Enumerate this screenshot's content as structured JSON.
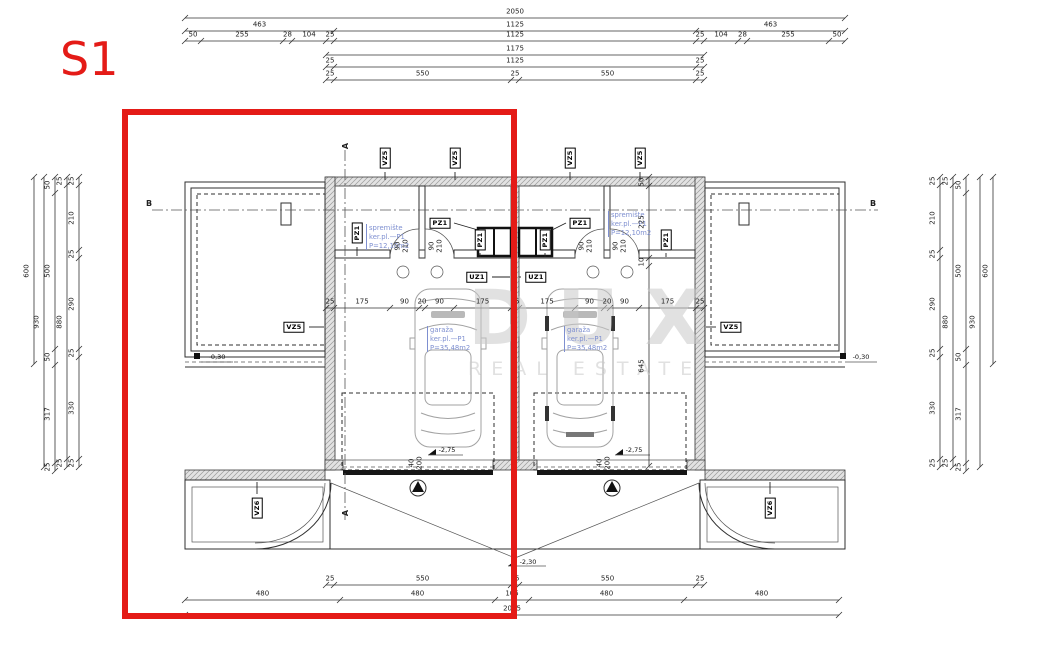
{
  "meta": {
    "title": "S1"
  },
  "watermark": {
    "line1": "DUX",
    "line2": "REAL ESTATE"
  },
  "colors": {
    "accent": "#e41b17",
    "blueprint_text": "#7e8fd0",
    "watermark": "#c9c9c9"
  },
  "rooms": [
    {
      "name": "spremište",
      "finish": "ker.pl.—P1",
      "area": "P=12,10m2"
    },
    {
      "name": "spremište",
      "finish": "ker.pl.—P1",
      "area": "P=12,10m2"
    },
    {
      "name": "garaža",
      "finish": "ker.pl.—P1",
      "area": "P=35,48m2"
    },
    {
      "name": "garaža",
      "finish": "ker.pl.—P1",
      "area": "P=35,48m2"
    }
  ],
  "dims": [
    {
      "o": "h",
      "y": 18,
      "t": [
        185,
        845
      ],
      "v": [
        "2050"
      ]
    },
    {
      "o": "h",
      "y": 31,
      "t": [
        185,
        334,
        696,
        845
      ],
      "v": [
        "463",
        "1125",
        "463"
      ]
    },
    {
      "o": "h",
      "y": 41,
      "t": [
        185,
        201,
        283,
        292,
        326,
        334,
        696,
        704,
        738,
        747,
        829,
        845
      ],
      "v": [
        "50",
        "255",
        "28",
        "104",
        "25",
        "1125",
        "25",
        "104",
        "28",
        "255",
        "50"
      ]
    },
    {
      "o": "h",
      "y": 55,
      "t": [
        326,
        704
      ],
      "v": [
        "1175"
      ]
    },
    {
      "o": "h",
      "y": 67,
      "t": [
        326,
        334,
        696,
        704
      ],
      "v": [
        "25",
        "1125",
        "25"
      ]
    },
    {
      "o": "h",
      "y": 80,
      "t": [
        326,
        334,
        511,
        519,
        696,
        704
      ],
      "v": [
        "25",
        "550",
        "25",
        "550",
        "25"
      ]
    },
    {
      "o": "h",
      "y": 308,
      "t": [
        326,
        334,
        390,
        419,
        425,
        454,
        511,
        519,
        575,
        604,
        610,
        639,
        696,
        704
      ],
      "v": [
        "25",
        "175",
        "90",
        "20",
        "90",
        "175",
        "25",
        "175",
        "90",
        "20",
        "90",
        "175",
        "25"
      ]
    },
    {
      "o": "h",
      "y": 585,
      "t": [
        326,
        334,
        511,
        519,
        696,
        704
      ],
      "v": [
        "25",
        "550",
        "25",
        "550",
        "25"
      ]
    },
    {
      "o": "h",
      "y": 600,
      "t": [
        185,
        340,
        495,
        529,
        684,
        839
      ],
      "v": [
        "480",
        "480",
        "105",
        "480",
        "480"
      ]
    },
    {
      "o": "h",
      "y": 615,
      "t": [
        185,
        839
      ],
      "v": [
        "2025"
      ]
    },
    {
      "o": "v",
      "x": 34,
      "t": [
        177,
        364
      ],
      "v": [
        "600"
      ]
    },
    {
      "o": "v",
      "x": 44,
      "t": [
        177,
        467
      ],
      "v": [
        "930"
      ]
    },
    {
      "o": "v",
      "x": 55,
      "t": [
        177,
        193,
        349,
        365,
        463,
        471
      ],
      "v": [
        "50",
        "500",
        "50",
        "317",
        "25"
      ]
    },
    {
      "o": "v",
      "x": 67,
      "t": [
        177,
        185,
        459,
        467
      ],
      "v": [
        "25",
        "880",
        "25"
      ]
    },
    {
      "o": "v",
      "x": 79,
      "t": [
        177,
        185,
        250,
        258,
        349,
        357,
        459,
        467
      ],
      "v": [
        "25",
        "210",
        "25",
        "290",
        "25",
        "330",
        "25"
      ]
    },
    {
      "o": "v",
      "x": 993,
      "t": [
        177,
        364
      ],
      "v": [
        "600"
      ]
    },
    {
      "o": "v",
      "x": 980,
      "t": [
        177,
        467
      ],
      "v": [
        "930"
      ]
    },
    {
      "o": "v",
      "x": 966,
      "t": [
        177,
        193,
        349,
        365,
        463,
        471
      ],
      "v": [
        "50",
        "500",
        "50",
        "317",
        "25"
      ]
    },
    {
      "o": "v",
      "x": 953,
      "t": [
        177,
        185,
        459,
        467
      ],
      "v": [
        "25",
        "880",
        "25"
      ]
    },
    {
      "o": "v",
      "x": 940,
      "t": [
        177,
        185,
        250,
        258,
        349,
        357,
        459,
        467
      ],
      "v": [
        "25",
        "210",
        "25",
        "290",
        "25",
        "330",
        "25"
      ]
    },
    {
      "o": "v",
      "x": 649,
      "t": [
        177,
        186,
        258,
        266,
        466
      ],
      "v": [
        "50",
        "225",
        "10",
        "645"
      ]
    }
  ],
  "labels": [
    {
      "t": "A",
      "x": 346,
      "y": 146,
      "r": 1,
      "c": "sec"
    },
    {
      "t": "A",
      "x": 346,
      "y": 513,
      "r": 1,
      "c": "sec"
    },
    {
      "t": "B",
      "x": 149,
      "y": 204,
      "c": "sec"
    },
    {
      "t": "B",
      "x": 873,
      "y": 204,
      "c": "sec"
    },
    {
      "t": "90",
      "x": 398,
      "y": 246,
      "r": 1
    },
    {
      "t": "210",
      "x": 406,
      "y": 246,
      "r": 1
    },
    {
      "t": "90",
      "x": 432,
      "y": 246,
      "r": 1
    },
    {
      "t": "210",
      "x": 440,
      "y": 246,
      "r": 1
    },
    {
      "t": "90",
      "x": 582,
      "y": 246,
      "r": 1
    },
    {
      "t": "210",
      "x": 590,
      "y": 246,
      "r": 1
    },
    {
      "t": "90",
      "x": 616,
      "y": 246,
      "r": 1
    },
    {
      "t": "210",
      "x": 624,
      "y": 246,
      "r": 1
    },
    {
      "t": "40",
      "x": 412,
      "y": 463,
      "r": 1
    },
    {
      "t": "200",
      "x": 420,
      "y": 463,
      "r": 1
    },
    {
      "t": "40",
      "x": 600,
      "y": 463,
      "r": 1
    },
    {
      "t": "200",
      "x": 608,
      "y": 463,
      "r": 1
    },
    {
      "t": "-2,75",
      "x": 447,
      "y": 450,
      "c": "lvl"
    },
    {
      "t": "-2,75",
      "x": 634,
      "y": 450,
      "c": "lvl"
    },
    {
      "t": "-2,30",
      "x": 528,
      "y": 562,
      "c": "lvl"
    },
    {
      "t": "-0,30",
      "x": 217,
      "y": 357,
      "c": "lvl"
    },
    {
      "t": "-0,30",
      "x": 861,
      "y": 357,
      "c": "lvl"
    }
  ],
  "tags": [
    {
      "t": "VZ5",
      "x": 385,
      "y": 158,
      "r": 1,
      "l": [
        385,
        172,
        385,
        180
      ]
    },
    {
      "t": "VZ5",
      "x": 455,
      "y": 158,
      "r": 1,
      "l": [
        455,
        172,
        455,
        180
      ]
    },
    {
      "t": "VZ5",
      "x": 570,
      "y": 158,
      "r": 1,
      "l": [
        570,
        172,
        570,
        180
      ]
    },
    {
      "t": "VZ5",
      "x": 640,
      "y": 158,
      "r": 1,
      "l": [
        640,
        172,
        640,
        180
      ]
    },
    {
      "t": "VZ5",
      "x": 294,
      "y": 327,
      "l": [
        309,
        327,
        324,
        327
      ]
    },
    {
      "t": "VZ5",
      "x": 731,
      "y": 327,
      "l": [
        716,
        327,
        706,
        327
      ]
    },
    {
      "t": "VZ6",
      "x": 257,
      "y": 508,
      "r": 1,
      "l": [
        257,
        494,
        257,
        482
      ]
    },
    {
      "t": "VZ6",
      "x": 770,
      "y": 508,
      "r": 1,
      "l": [
        770,
        494,
        770,
        482
      ]
    },
    {
      "t": "PZ1",
      "x": 357,
      "y": 233,
      "r": 1,
      "l": [
        357,
        247,
        357,
        256
      ]
    },
    {
      "t": "PZ1",
      "x": 480,
      "y": 240,
      "r": 1,
      "l": [
        480,
        253,
        480,
        257
      ]
    },
    {
      "t": "PZ1",
      "x": 545,
      "y": 240,
      "r": 1,
      "l": [
        545,
        253,
        545,
        257
      ]
    },
    {
      "t": "PZ1",
      "x": 666,
      "y": 240,
      "r": 1,
      "l": [
        666,
        253,
        666,
        257
      ]
    },
    {
      "t": "PZ1",
      "x": 440,
      "y": 223,
      "l": [
        454,
        223,
        478,
        230
      ]
    },
    {
      "t": "PZ1",
      "x": 580,
      "y": 223,
      "l": [
        566,
        223,
        552,
        230
      ]
    },
    {
      "t": "UZ1",
      "x": 477,
      "y": 277,
      "l": [
        492,
        277,
        510,
        277
      ]
    },
    {
      "t": "UZ1",
      "x": 536,
      "y": 277,
      "l": [
        521,
        277,
        519,
        277
      ]
    }
  ]
}
